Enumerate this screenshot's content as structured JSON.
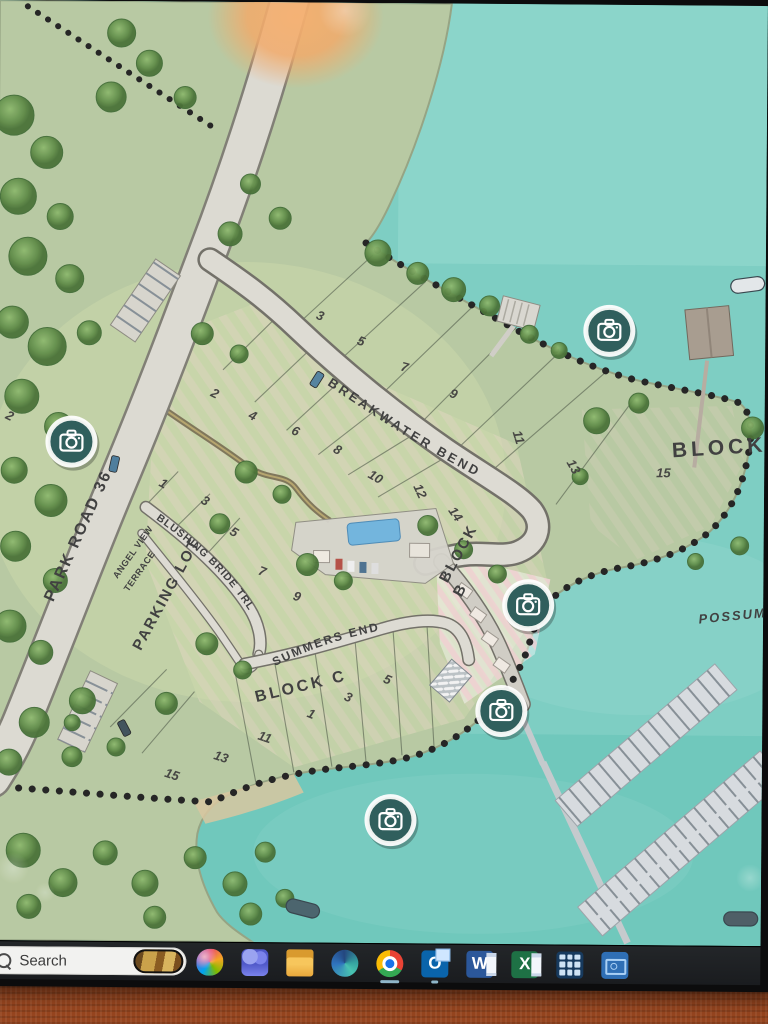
{
  "map": {
    "title_labels": [
      {
        "id": "park-road-36",
        "text": "PARK ROAD 36",
        "path": "pathParkRoad",
        "size": 16,
        "ls": 2
      },
      {
        "id": "breakwater-bend",
        "text": "BREAKWATER BEND",
        "path": "pathBreakLabel",
        "size": 13,
        "ls": 3
      },
      {
        "id": "blushing-bride-trl",
        "text": "BLUSHING BRIDE TRL",
        "path": "pathBlushLabel",
        "size": 10.5,
        "ls": 1
      },
      {
        "id": "summers-end",
        "text": "SUMMERS END",
        "path": "pathSummersLabel",
        "size": 12,
        "ls": 2
      },
      {
        "id": "angel-view-line1",
        "text": "ANGEL VIEW",
        "x": 122,
        "y": 578,
        "rot": -55,
        "size": 9,
        "ls": 0.5
      },
      {
        "id": "angel-view-line2",
        "text": "TERRACE",
        "x": 133,
        "y": 591,
        "rot": -55,
        "size": 9,
        "ls": 0.5
      },
      {
        "id": "parking-lot",
        "text": "PARKING LOT",
        "x": 146,
        "y": 650,
        "rot": -62,
        "size": 15,
        "ls": 2
      },
      {
        "id": "block-a",
        "text": "BLOCK A",
        "x": 676,
        "y": 452,
        "rot": -4,
        "size": 21,
        "ls": 4
      },
      {
        "id": "block-b-line1",
        "text": "BLOCK",
        "x": 452,
        "y": 580,
        "rot": -62,
        "size": 15,
        "ls": 2
      },
      {
        "id": "block-b-line2",
        "text": "B",
        "x": 466,
        "y": 594,
        "rot": -62,
        "size": 15,
        "ls": 2
      },
      {
        "id": "block-c",
        "text": "BLOCK C",
        "x": 262,
        "y": 700,
        "rot": -14,
        "size": 16,
        "ls": 3
      },
      {
        "id": "possum-lake",
        "text": "POSSUM",
        "x": 704,
        "y": 618,
        "rot": -6,
        "size": 13,
        "ls": 2,
        "italic": true
      }
    ],
    "lot_numbers": [
      [
        "2",
        8,
        418,
        25
      ],
      [
        "3",
        318,
        316,
        20
      ],
      [
        "5",
        359,
        341,
        20
      ],
      [
        "7",
        403,
        367,
        15
      ],
      [
        "9",
        452,
        393,
        20
      ],
      [
        "11",
        516,
        428,
        72
      ],
      [
        "13",
        570,
        458,
        60
      ],
      [
        "2",
        213,
        394,
        25
      ],
      [
        "4",
        251,
        416,
        25
      ],
      [
        "6",
        294,
        431,
        25
      ],
      [
        "8",
        336,
        449,
        28
      ],
      [
        "10",
        371,
        474,
        30
      ],
      [
        "12",
        417,
        483,
        65
      ],
      [
        "14",
        452,
        507,
        55
      ],
      [
        "1",
        162,
        484,
        30
      ],
      [
        "3",
        204,
        501,
        30
      ],
      [
        "5",
        233,
        532,
        30
      ],
      [
        "7",
        262,
        572,
        20
      ],
      [
        "9",
        297,
        597,
        18
      ],
      [
        "15",
        660,
        472,
        0
      ],
      [
        "5",
        388,
        679,
        22
      ],
      [
        "3",
        349,
        697,
        22
      ],
      [
        "1",
        312,
        714,
        22
      ],
      [
        "11",
        263,
        737,
        18
      ],
      [
        "13",
        219,
        757,
        18
      ],
      [
        "15",
        170,
        775,
        18
      ]
    ],
    "camera_markers": [
      [
        75,
        441
      ],
      [
        612,
        326
      ],
      [
        533,
        601
      ],
      [
        507,
        707
      ],
      [
        397,
        817
      ]
    ],
    "trees": [
      [
        15,
        115,
        20
      ],
      [
        48,
        152,
        16
      ],
      [
        20,
        196,
        18
      ],
      [
        62,
        216,
        13
      ],
      [
        30,
        256,
        19
      ],
      [
        72,
        278,
        14
      ],
      [
        15,
        322,
        16
      ],
      [
        50,
        346,
        19
      ],
      [
        92,
        332,
        12
      ],
      [
        25,
        396,
        17
      ],
      [
        62,
        426,
        14
      ],
      [
        18,
        470,
        13
      ],
      [
        55,
        500,
        16
      ],
      [
        20,
        546,
        15
      ],
      [
        60,
        580,
        12
      ],
      [
        15,
        626,
        16
      ],
      [
        46,
        652,
        12
      ],
      [
        88,
        700,
        13
      ],
      [
        40,
        722,
        15
      ],
      [
        15,
        762,
        13
      ],
      [
        78,
        756,
        10
      ],
      [
        112,
        96,
        15
      ],
      [
        150,
        62,
        13
      ],
      [
        186,
        96,
        11
      ],
      [
        122,
        32,
        14
      ],
      [
        252,
        182,
        10
      ],
      [
        282,
        216,
        11
      ],
      [
        232,
        232,
        12
      ],
      [
        205,
        332,
        11
      ],
      [
        242,
        352,
        9
      ],
      [
        380,
        250,
        13
      ],
      [
        420,
        270,
        11
      ],
      [
        456,
        286,
        12
      ],
      [
        492,
        302,
        10
      ],
      [
        532,
        330,
        9
      ],
      [
        562,
        346,
        8
      ],
      [
        250,
        470,
        11
      ],
      [
        286,
        492,
        9
      ],
      [
        224,
        522,
        10
      ],
      [
        312,
        562,
        11
      ],
      [
        348,
        578,
        9
      ],
      [
        432,
        522,
        10
      ],
      [
        468,
        546,
        9
      ],
      [
        502,
        570,
        9
      ],
      [
        600,
        416,
        13
      ],
      [
        642,
        398,
        10
      ],
      [
        756,
        422,
        11
      ],
      [
        744,
        540,
        9
      ],
      [
        700,
        556,
        8
      ],
      [
        584,
        472,
        8
      ],
      [
        212,
        642,
        11
      ],
      [
        248,
        668,
        9
      ],
      [
        172,
        702,
        11
      ],
      [
        122,
        746,
        9
      ],
      [
        78,
        722,
        8
      ],
      [
        30,
        850,
        17
      ],
      [
        70,
        882,
        14
      ],
      [
        112,
        852,
        12
      ],
      [
        152,
        882,
        13
      ],
      [
        202,
        856,
        11
      ],
      [
        242,
        882,
        12
      ],
      [
        272,
        850,
        10
      ],
      [
        258,
        912,
        11
      ],
      [
        292,
        896,
        9
      ],
      [
        36,
        906,
        12
      ],
      [
        162,
        916,
        11
      ]
    ],
    "cars": [
      [
        118,
        463,
        12,
        "#4a7a9a"
      ],
      [
        130,
        727,
        -28,
        "#3c4f58"
      ],
      [
        320,
        377,
        32,
        "#51809d"
      ]
    ],
    "boats": [
      [
        750,
        279,
        -8,
        "#e3e7e9"
      ],
      [
        310,
        906,
        14,
        "#47606a"
      ],
      [
        748,
        913,
        0,
        "#4a5a63"
      ]
    ],
    "colors": {
      "water": "#7acdc2",
      "land": "#b6c8a0",
      "road": "#dbd9d1",
      "boundary_dots": "#1f1f1f",
      "camera_marker": "#2a5a58",
      "glare": "#f5a865",
      "fabric": "#96451f",
      "taskbar": "#1d1f22"
    }
  },
  "taskbar": {
    "search": {
      "label": "Search"
    },
    "items": [
      {
        "name": "copilot"
      },
      {
        "name": "teams"
      },
      {
        "name": "file-explorer"
      },
      {
        "name": "edge"
      },
      {
        "name": "chrome",
        "active": true
      },
      {
        "name": "outlook",
        "active": true,
        "letter": "O"
      },
      {
        "name": "word",
        "letter": "W"
      },
      {
        "name": "excel",
        "letter": "X"
      },
      {
        "name": "calculator-app"
      },
      {
        "name": "scanner-app"
      }
    ]
  }
}
